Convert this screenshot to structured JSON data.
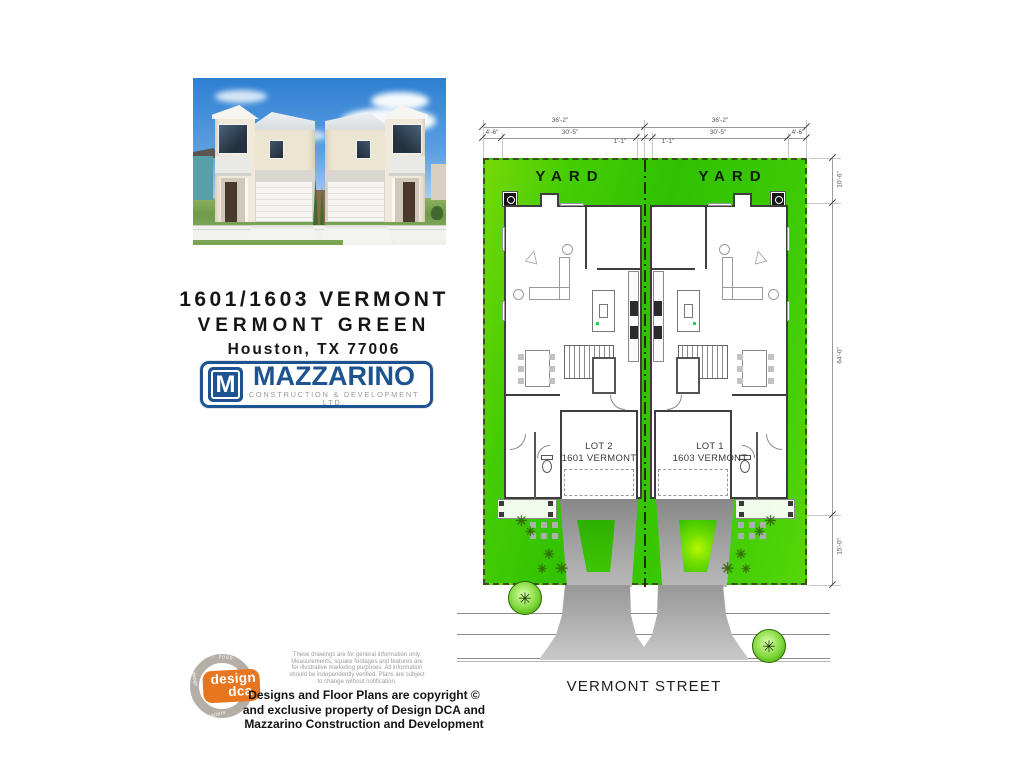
{
  "title_block": {
    "line1": "1601/1603 VERMONT",
    "line2": "VERMONT GREEN",
    "line3": "Houston, TX 77006"
  },
  "builder_logo": {
    "monogram": "M",
    "name": "MAZZARINO",
    "tagline": "CONSTRUCTION & DEVELOPMENT LTD.",
    "brand_blue": "#1d5391"
  },
  "dca_logo": {
    "ring_top": "est. 2000",
    "ring_side": "design",
    "ring_bottom": "matters",
    "name_line1": "design",
    "name_line2": "dca",
    "brand_orange": "#e8761e"
  },
  "disclaimer_lines": [
    "These drawings are for general information only.",
    "Measurements, square footages and features are",
    "for illustrative marketing purposes. All information",
    "should be independently verified. Plans are subject",
    "to change without notification."
  ],
  "copyright_lines": [
    "Designs and Floor Plans are copyright ©",
    "and exclusive property of  Design DCA and",
    "Mazzarino Construction and Development"
  ],
  "site_plan": {
    "yard_label_left": "YARD",
    "yard_label_right": "YARD",
    "street_label": "VERMONT STREET",
    "lots": [
      {
        "lot_label": "LOT 2",
        "address": "1601 VERMONT"
      },
      {
        "lot_label": "LOT 1",
        "address": "1603 VERMONT"
      }
    ],
    "dimensions": {
      "top_spans": [
        "36'-2\"",
        "36'-2\""
      ],
      "sub_spans": [
        "4'-6\"",
        "30'-5\"",
        "1'-1\"",
        "1'-1\"",
        "30'-5\"",
        "4'-6\""
      ],
      "side_spans": [
        "10'-6\"",
        "64'-0\"",
        "15'-0\""
      ]
    },
    "colors": {
      "lawn_green": "#3ecb05",
      "lawn_green_light": "#76d906",
      "driveway_gray": "#9a9a9a"
    }
  }
}
